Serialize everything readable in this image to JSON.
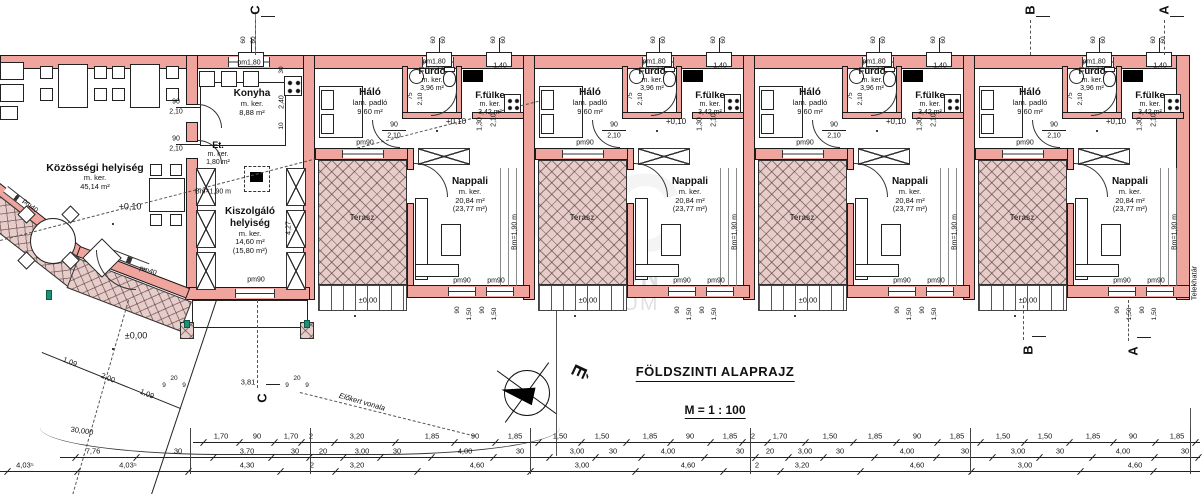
{
  "title": {
    "main": "FÖLDSZINTI ALAPRAJZ",
    "scale": "M = 1 : 100"
  },
  "watermark": {
    "logo": "OC",
    "line1": "OTTHON",
    "line2": "CENTRUM"
  },
  "compass": {
    "north": "É"
  },
  "colors": {
    "wall": "#f0a49e",
    "hatch_bg": "#e6cdc9",
    "line": "#1a1a1a",
    "green_marker": "#1f8f75",
    "watermark_grey": "#c6c6c6"
  },
  "sections": {
    "top": [
      {
        "l": "C",
        "x": 255
      },
      {
        "l": "B",
        "x": 1030
      },
      {
        "l": "A",
        "x": 1164
      }
    ],
    "bottom": [
      {
        "l": "C",
        "x": 262,
        "y": 398
      },
      {
        "l": "B",
        "x": 1028,
        "y": 350
      },
      {
        "l": "A",
        "x": 1133,
        "y": 351
      }
    ]
  },
  "left_wing": {
    "rooms": {
      "kozossegi": {
        "name": "Közösségi helyiség",
        "finish": "m. ker.",
        "area": "45,14 m²"
      },
      "konyha": {
        "name": "Konyha",
        "finish": "m. ker.",
        "area": "8,88 m²"
      },
      "et": {
        "name": "Et.",
        "finish": "m. ker.",
        "area": "1,80 m²"
      },
      "kiszolgalo": {
        "name": "Kiszolgáló",
        "name2": "helyiség",
        "finish": "m. ker.",
        "area": "14,60 m²",
        "area_alt": "(15,80 m²)"
      }
    }
  },
  "unit": {
    "count": 4,
    "rooms": {
      "halo": {
        "name": "Háló",
        "finish": "lam. padló",
        "area": "9,60 m²"
      },
      "furdo": {
        "name": "Fürdő",
        "finish": "m. ker.",
        "area": "3,96 m²"
      },
      "fulke": {
        "name": "F.fülke",
        "finish": "m. ker.",
        "area": "3,42 m²"
      },
      "nappali": {
        "name": "Nappali",
        "finish": "m. ker.",
        "area": "20,84 m²",
        "area_alt": "(23,77 m²)"
      },
      "terasz": {
        "name": "Terasz"
      }
    },
    "ann": {
      "pm180": "pm1,80",
      "pm140": "1,40",
      "pm90": "pm90",
      "plus010": "+0,10",
      "zero": "±0,00",
      "bm": "Bm=1,90 m",
      "d90": "90",
      "d210": "2,10",
      "d130": "1,30",
      "d75": "75",
      "d60": "60",
      "d150": "1,50"
    }
  },
  "labels": [
    {
      "t": "+0,10",
      "x": 130,
      "y": 207,
      "s": 9
    },
    {
      "t": "±0,00",
      "x": 136,
      "y": 336,
      "s": 9
    },
    {
      "t": "pm1,80",
      "x": 249,
      "y": 63,
      "s": 7
    },
    {
      "t": "pm90",
      "x": 256,
      "y": 280,
      "s": 7
    },
    {
      "t": "90",
      "x": 176,
      "y": 102,
      "s": 7
    },
    {
      "t": "2,10",
      "x": 176,
      "y": 112,
      "s": 7
    },
    {
      "t": "90",
      "x": 176,
      "y": 139,
      "s": 7
    },
    {
      "t": "2,10",
      "x": 176,
      "y": 149,
      "s": 7
    },
    {
      "t": "Bm=1,90 m",
      "x": 213,
      "y": 192,
      "s": 7
    },
    {
      "t": "4,27",
      "x": 289,
      "y": 228,
      "r": -90,
      "s": 7
    },
    {
      "t": "2,40",
      "x": 282,
      "y": 102,
      "r": -90,
      "s": 7
    },
    {
      "t": "30",
      "x": 282,
      "y": 70,
      "r": -90,
      "s": 6.5
    },
    {
      "t": "10",
      "x": 282,
      "y": 126,
      "r": -90,
      "s": 6.5
    },
    {
      "t": "pm40",
      "x": 30,
      "y": 206,
      "r": 40,
      "s": 7
    },
    {
      "t": "pm40",
      "x": 148,
      "y": 271,
      "r": 18,
      "s": 7
    },
    {
      "t": "1,09",
      "x": 70,
      "y": 362,
      "r": 22,
      "s": 7.5
    },
    {
      "t": "2,00",
      "x": 108,
      "y": 378,
      "r": 22,
      "s": 7.5
    },
    {
      "t": "1,09",
      "x": 147,
      "y": 394,
      "r": 22,
      "s": 7.5
    },
    {
      "t": "30,000",
      "x": 82,
      "y": 431,
      "r": 8,
      "s": 7.5
    },
    {
      "t": "9",
      "x": 164,
      "y": 386,
      "s": 6.5
    },
    {
      "t": "20",
      "x": 174,
      "y": 379,
      "s": 6.5
    },
    {
      "t": "9",
      "x": 184,
      "y": 386,
      "s": 6.5
    },
    {
      "t": "3,81",
      "x": 248,
      "y": 382,
      "s": 7.5
    },
    {
      "t": "9",
      "x": 287,
      "y": 386,
      "s": 6.5
    },
    {
      "t": "20",
      "x": 297,
      "y": 379,
      "s": 6.5
    },
    {
      "t": "9",
      "x": 307,
      "y": 386,
      "s": 6.5
    },
    {
      "t": "Előkert vonala",
      "x": 362,
      "y": 402,
      "r": 16,
      "s": 7.5,
      "i": 1
    },
    {
      "t": "Telekhatár",
      "x": 1194,
      "y": 283,
      "r": -90,
      "s": 7.5
    },
    {
      "t": "60",
      "x": 244,
      "y": 40,
      "r": -90,
      "s": 6.5
    },
    {
      "t": "60",
      "x": 254,
      "y": 40,
      "r": -90,
      "s": 6.5
    }
  ],
  "dims": {
    "row1": [
      [
        "1,70",
        221
      ],
      [
        "90",
        257
      ],
      [
        "1,70",
        291
      ],
      [
        "2",
        311
      ],
      [
        "3,20",
        357
      ],
      [
        "1,85",
        432
      ],
      [
        "90",
        475
      ],
      [
        "1,85",
        515
      ],
      [
        "1,50",
        560
      ],
      [
        "1,50",
        602
      ],
      [
        "1,85",
        650
      ],
      [
        "90",
        690
      ],
      [
        "1,85",
        730
      ],
      [
        "2",
        753
      ],
      [
        "1,70",
        780
      ],
      [
        "1,50",
        830
      ],
      [
        "1,85",
        875
      ],
      [
        "90",
        917
      ],
      [
        "1,85",
        957
      ],
      [
        "1,50",
        1003
      ],
      [
        "1,50",
        1045
      ],
      [
        "1,85",
        1093
      ],
      [
        "90",
        1133
      ],
      [
        "1,85",
        1177
      ]
    ],
    "row2": [
      [
        "7,76",
        93
      ],
      [
        "30",
        178
      ],
      [
        "3,70",
        247
      ],
      [
        "30",
        295
      ],
      [
        "20",
        323
      ],
      [
        "3,00",
        362
      ],
      [
        "30",
        397
      ],
      [
        "4,00",
        465
      ],
      [
        "30",
        520
      ],
      [
        "3,00",
        577
      ],
      [
        "30",
        613
      ],
      [
        "4,00",
        668
      ],
      [
        "30",
        740
      ],
      [
        "20",
        770
      ],
      [
        "3,00",
        805
      ],
      [
        "30",
        840
      ],
      [
        "4,00",
        907
      ],
      [
        "30",
        965
      ],
      [
        "3,00",
        1018
      ],
      [
        "30",
        1060
      ],
      [
        "4,00",
        1123
      ],
      [
        "30",
        1185
      ]
    ],
    "row3": [
      [
        "4,03⁵",
        25
      ],
      [
        "4,03⁵",
        128
      ],
      [
        "4,30",
        247
      ],
      [
        "2",
        312
      ],
      [
        "3,20",
        357
      ],
      [
        "4,60",
        477
      ],
      [
        "3,00",
        582
      ],
      [
        "4,60",
        688
      ],
      [
        "2",
        757
      ],
      [
        "3,20",
        802
      ],
      [
        "4,60",
        917
      ],
      [
        "3,00",
        1025
      ],
      [
        "4,60",
        1135
      ]
    ]
  }
}
